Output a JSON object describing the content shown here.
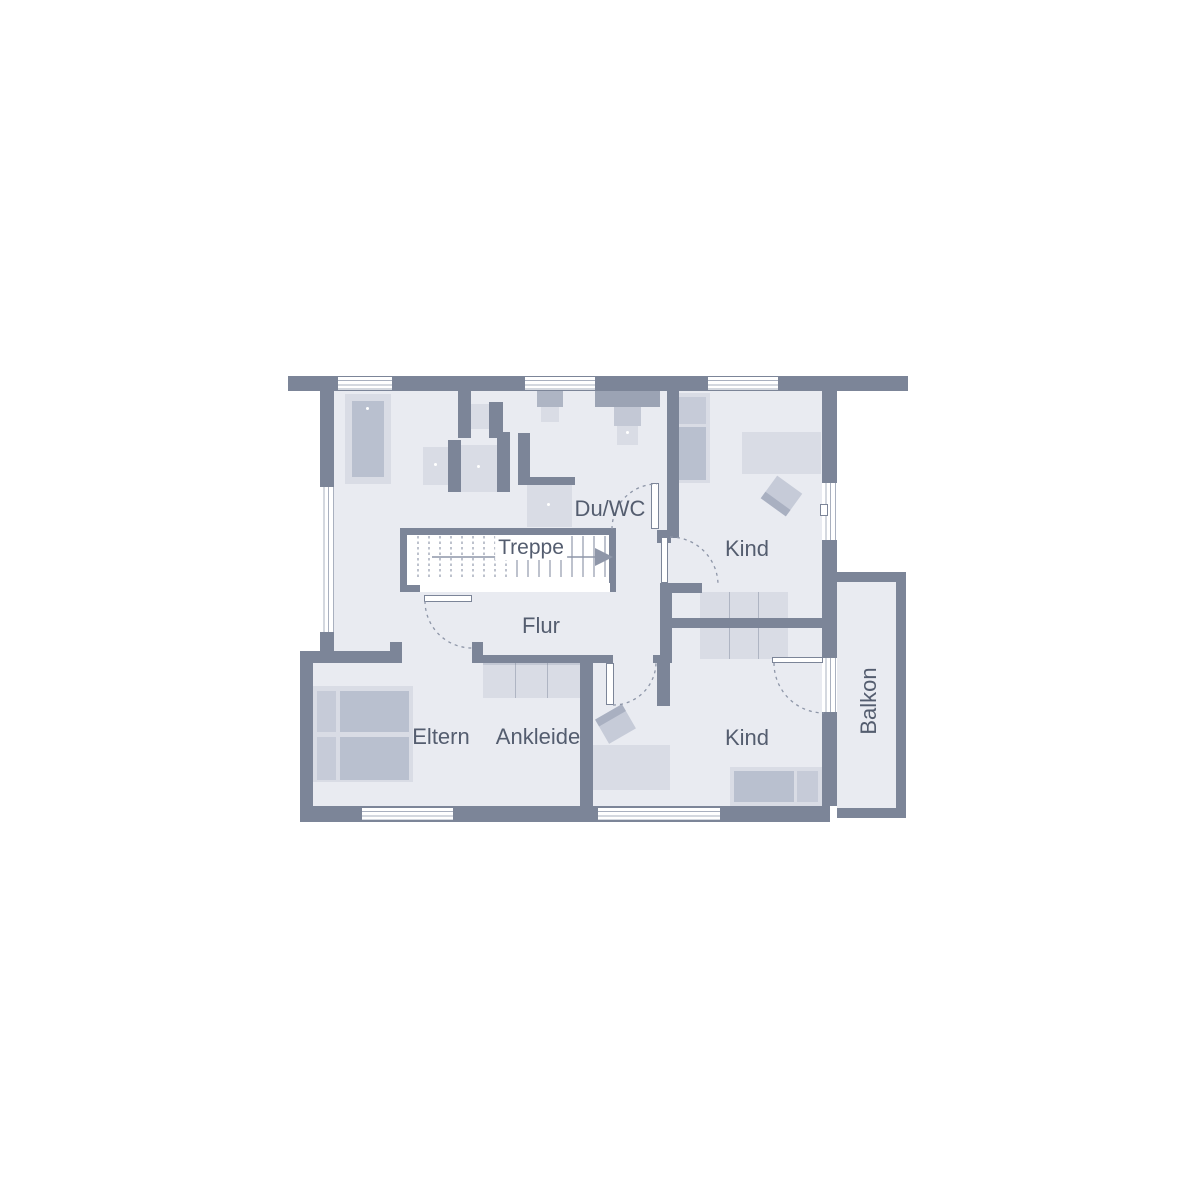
{
  "plan": {
    "type": "floor-plan",
    "rooms": {
      "duwc": "Du/WC",
      "treppe": "Treppe",
      "kind_top": "Kind",
      "flur": "Flur",
      "eltern": "Eltern",
      "ankleide": "Ankleide",
      "kind_bottom": "Kind",
      "balkon": "Balkon"
    }
  },
  "colors": {
    "wall": "#7c8598",
    "floor": "#e9ebf1",
    "furniture_light": "#d9dce5",
    "furniture_mid": "#c6cbd8",
    "furniture_dark": "#b9c0cf",
    "line": "#8e96a8",
    "text": "#545d6f",
    "background": "#ffffff"
  }
}
